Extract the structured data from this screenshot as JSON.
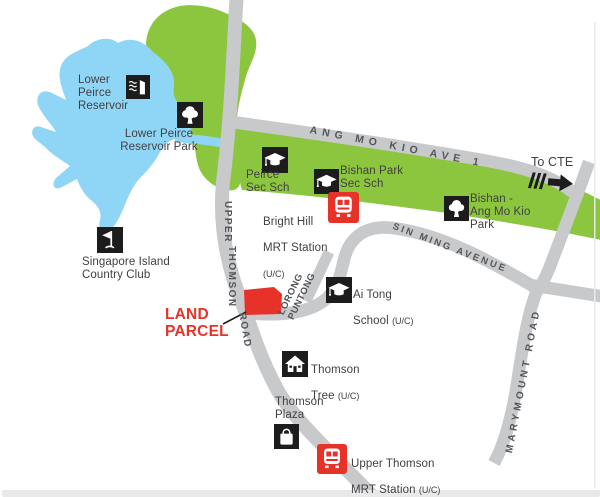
{
  "colors": {
    "park_green": "#8CC63F",
    "water_blue": "#8FD6F6",
    "road_gray": "#C8C9CB",
    "accent_red": "#E73229",
    "icon_black": "#1C1C1C",
    "label_text": "#414042",
    "road_text": "#55565A",
    "footer_bar": "#E9E9EA"
  },
  "pois": {
    "lower_peirce_reservoir": {
      "name": "Lower\nPeirce\nReservoir",
      "icon": "dam-icon"
    },
    "lower_peirce_reservoir_park": {
      "name": "Lower Peirce\nReservoir Park",
      "icon": "tree-icon"
    },
    "peirce_sec_sch": {
      "name": "Peirce\nSec Sch",
      "icon": "graduation-cap-icon"
    },
    "bishan_park_sec_sch": {
      "name": "Bishan Park\nSec Sch",
      "icon": "graduation-cap-icon"
    },
    "bishan_ang_mo_kio_park": {
      "name": "Bishan -\nAng Mo Kio\nPark",
      "icon": "tree-icon"
    },
    "singapore_island_country_club": {
      "name": "Singapore Island\nCountry Club",
      "icon": "golf-flag-icon"
    },
    "bright_hill_mrt": {
      "line1": "Bright Hill",
      "line2": "MRT Station",
      "uc": "(U/C)",
      "icon": "mrt-train-icon"
    },
    "ai_tong_school": {
      "line1": "Ai Tong",
      "line2": "School",
      "uc": "(U/C)",
      "icon": "graduation-cap-icon"
    },
    "thomson_tree": {
      "line1": "Thomson",
      "line2": "Tree",
      "uc": "(U/C)",
      "icon": "house-icon"
    },
    "thomson_plaza": {
      "name": "Thomson\nPlaza",
      "icon": "shopping-bag-icon"
    },
    "upper_thomson_mrt": {
      "line1": "Upper Thomson",
      "line2": "MRT Station",
      "uc": "(U/C)",
      "icon": "mrt-train-icon"
    },
    "land_parcel": {
      "name": "LAND\nPARCEL"
    },
    "to_cte": {
      "name": "To CTE",
      "icon": "arrow-right-icon"
    }
  },
  "roads": {
    "upper_thomson": {
      "word1": "UPPER",
      "word2": "THOMSON",
      "word3": "ROAD"
    },
    "ang_mo_kio_ave_1": {
      "name": "ANG MO KIO AVE 1"
    },
    "sin_ming_avenue": {
      "name": "SIN MING AVENUE"
    },
    "marymount_road": {
      "name": "MARYMOUNT ROAD"
    },
    "lorong_puntong": {
      "line1": "LORONG",
      "line2": "PUNTONG"
    }
  }
}
